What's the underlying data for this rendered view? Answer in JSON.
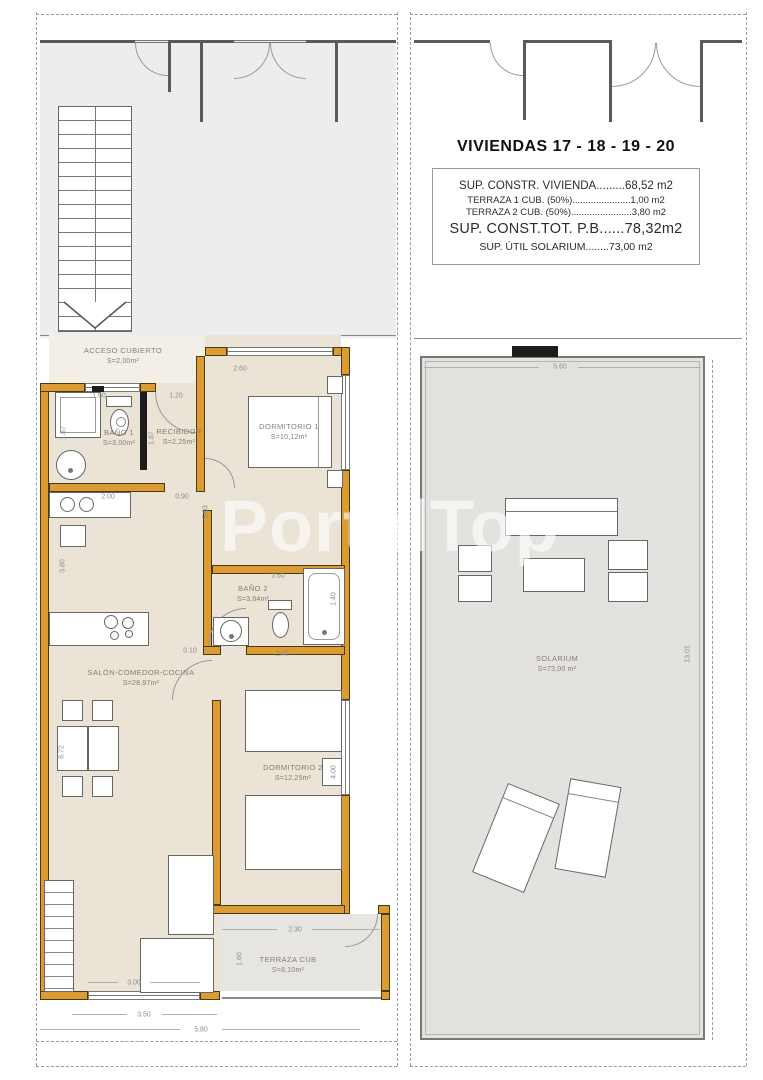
{
  "watermark": "PortalTop",
  "title_block": {
    "title": "VIVIENDAS  17 - 18 - 19 - 20",
    "lines": [
      {
        "label": "SUP. CONSTR. VIVIENDA",
        "dots": ".........",
        "value": "68,52 m2"
      },
      {
        "label": "TERRAZA 1 CUB. (50%)",
        "dots": "......................",
        "value": "1,00 m2"
      },
      {
        "label": "TERRAZA 2 CUB. (50%)",
        "dots": ".......................",
        "value": "3,80 m2"
      },
      {
        "label": "SUP. CONST.TOT. P.B",
        "dots": "......",
        "value": "78,32m2"
      },
      {
        "label": "SUP. ÚTIL SOLARIUM",
        "dots": "........",
        "value": "73,00 m2"
      }
    ]
  },
  "rooms": {
    "acceso": {
      "name": "ACCESO CUBIERTO",
      "area": "S=2,00m²"
    },
    "bano1": {
      "name": "BAÑO 1",
      "area": "S=3,00m²"
    },
    "recibidor": {
      "name": "RECIBIDOR",
      "area": "S=2,25m²"
    },
    "dormitorio1": {
      "name": "DORMITORIO 1",
      "area": "S=10,12m²"
    },
    "bano2": {
      "name": "BAÑO 2",
      "area": "S=3,64m²"
    },
    "salon": {
      "name": "SALÓN-COMEDOR-COCINA",
      "area": "S=28,97m²"
    },
    "dormitorio2": {
      "name": "DORMITORIO 2",
      "area": "S=12,25m²"
    },
    "terraza": {
      "name": "TERRAZA CUB",
      "area": "S=8,10m²"
    },
    "solarium": {
      "name": "SOLARIUM",
      "area": "S=73,00 m²"
    }
  },
  "dimensions": {
    "left": {
      "d160a": "1.60",
      "d120": "1.20",
      "d187a": "1.87",
      "d187b": "1.87",
      "d260a": "2.60",
      "d200": "2.00",
      "d090": "0.90",
      "d503": "5.03",
      "d380": "3.80",
      "d872": "8.72",
      "d260b": "2.60",
      "d140": "1.40",
      "d240": "2.40",
      "d010": "0.10",
      "d400": "4.00",
      "d230": "2.30",
      "d160b": "1.60",
      "d300": "3.00",
      "d350": "3.50",
      "d580": "5.80"
    },
    "right": {
      "d560": "5.60",
      "d1301": "13.01"
    }
  },
  "colors": {
    "wall": "#DC9B33",
    "floor": "#EAE3D6",
    "porch": "#F3EFE7",
    "top_gray": "#EDEDED",
    "terraza_gray": "#E7E5E2",
    "solarium": "#E3E2DF"
  }
}
